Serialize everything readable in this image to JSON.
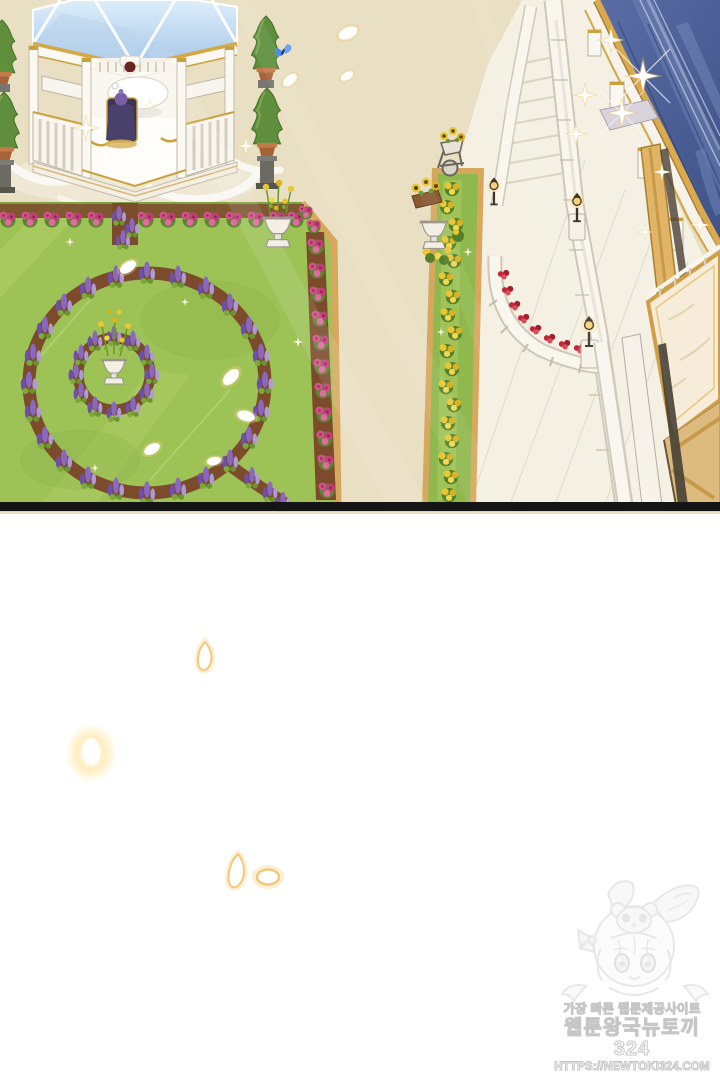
{
  "watermark": {
    "tagline": "가장 빠른 웹툰제공사이트",
    "site_name": "웹툰왕국뉴토끼324",
    "url": "HTTPS://NEWTOKI324.COM"
  },
  "scene": {
    "elements": [
      "gazebo with blue glass roof",
      "couple at table inside gazebo",
      "spiral topiary trees",
      "blue butterfly",
      "formal parterre garden with lupine rings",
      "pink rose hedges",
      "stone flower urns",
      "marigold hedge strip",
      "marble balustrade walkway",
      "curved balustrade with red roses",
      "street lamps",
      "palace with blue mansard roof",
      "sunflower cart and planters",
      "floating white petals",
      "gold sparkles",
      "faint rabbit-hood mascot sketch"
    ]
  },
  "colors": {
    "ground_tan": "#e9dfc3",
    "lawn_green": "#9dc255",
    "roof_blue": "#54679e",
    "gold_trim": "#c9a23c",
    "rose_pink": "#d4528b",
    "lupine_purple": "#8a68c2",
    "marigold_yellow": "#e9c733",
    "panel_border": "#151515",
    "watermark_gray": "#c6c6c6"
  }
}
